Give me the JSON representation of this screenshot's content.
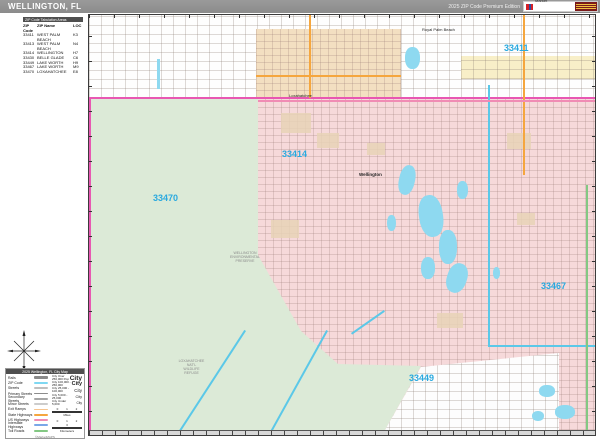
{
  "header": {
    "title": "WELLINGTON, FL",
    "edition": "2025 ZIP Code Premium Edition",
    "logo": {
      "brand_top": "Market",
      "brand_main": "MAPS"
    }
  },
  "zip_table": {
    "title": "ZIP Code Tabulation Areas",
    "columns": [
      "ZIP Code",
      "ZIP Name",
      "LOC"
    ],
    "rows": [
      {
        "zip": "33411",
        "name": "WEST PALM BEACH",
        "loc": "K3"
      },
      {
        "zip": "33413",
        "name": "WEST PALM BEACH",
        "loc": "N4"
      },
      {
        "zip": "33414",
        "name": "WELLINGTON",
        "loc": "H7"
      },
      {
        "zip": "33430",
        "name": "BELLE GLADE",
        "loc": "C6"
      },
      {
        "zip": "33449",
        "name": "LAKE WORTH",
        "loc": "H9"
      },
      {
        "zip": "33467",
        "name": "LAKE WORTH",
        "loc": "M9"
      },
      {
        "zip": "33470",
        "name": "LOXAHATCHEE",
        "loc": "E8"
      }
    ]
  },
  "map": {
    "zip_labels": [
      "33411",
      "33414",
      "33470",
      "33467",
      "33449"
    ],
    "place_labels": [
      "Royal Palm Beach",
      "Loxahatchee",
      "Wellington"
    ],
    "area_labels": {
      "refuge": [
        "LOXAHATCHEE",
        "NAT'L",
        "WILDLIFE",
        "REFUGE"
      ],
      "preserve": [
        "WELLINGTON",
        "ENVIRONMENTAL",
        "PRESERVE"
      ]
    },
    "colors": {
      "zip_label_blue": "#29a9df",
      "region_pink": "#f6d9da",
      "region_green": "#dcead7",
      "region_tan": "#f3dfc1",
      "region_yellow": "#f8efc8",
      "water": "#8ed9f0",
      "boundary_magenta": "#e857b2",
      "boundary_cyan": "#5bc8e8"
    }
  },
  "legend": {
    "title": "2025 Wellington, FL City Map",
    "road_rows": [
      {
        "label": "Rails",
        "color": "#8a8a8a"
      },
      {
        "label": "ZIP Code",
        "color": "#7fd8f2"
      },
      {
        "label": "Streets",
        "color": "#bfbfbf"
      },
      {
        "label": "Primary Streets",
        "color": "#8c8c8c"
      },
      {
        "label": "Secondary Streets",
        "color": "#a6a6a6"
      },
      {
        "label": "Minor Streets",
        "color": "#cccccc"
      },
      {
        "label": "Exit Ramps",
        "color": "#f6c48f"
      },
      {
        "label": "State Highways",
        "color": "#f5a63e"
      },
      {
        "label": "US Highways",
        "color": "#f08cb4"
      },
      {
        "label": "Interstate Highways",
        "color": "#7aa7e8"
      },
      {
        "label": "Toll Roads",
        "color": "#83c883"
      }
    ],
    "city_rows": [
      {
        "label": "City Over 250,000 Pop",
        "sample": "City"
      },
      {
        "label": "City 100,000 - 250,000",
        "sample": "City"
      },
      {
        "label": "City 25,000 - 100,000",
        "sample": "City"
      },
      {
        "label": "City 5,000 - 25,000",
        "sample": "City"
      },
      {
        "label": "City Under 5,000",
        "sample": "City"
      }
    ],
    "scales": [
      {
        "ticks": "0 1 2",
        "unit": "Miles"
      },
      {
        "ticks": "0 1 2 3",
        "unit": "Kilometers"
      }
    ],
    "footer": "©MarketMAPS"
  }
}
